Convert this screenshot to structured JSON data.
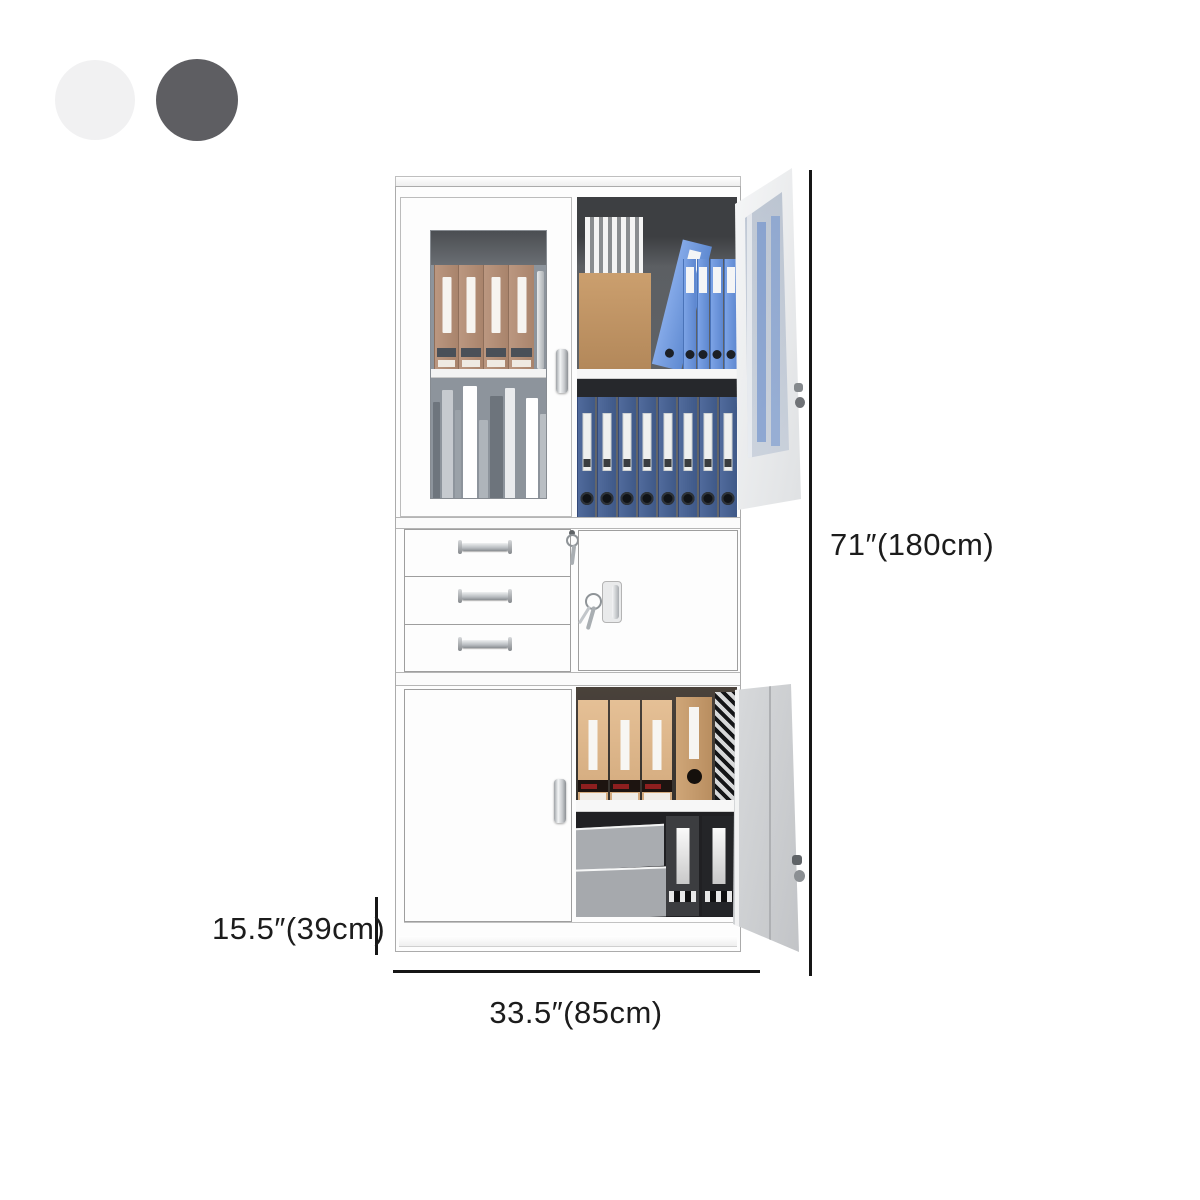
{
  "swatches": [
    {
      "name": "white",
      "color": "#F1F1F2"
    },
    {
      "name": "dark-gray",
      "color": "#5E5E62"
    }
  ],
  "dimensions": {
    "height_label": "71″(180cm)",
    "depth_label": "15.5″(39cm)",
    "width_label": "33.5″(85cm)"
  },
  "palette": {
    "dimension_line": "#161616",
    "cabinet_white": "#FCFCFC",
    "interior_dark": "#4E5053",
    "blue_binder": "#6D99E0",
    "navy_binder": "#46618F",
    "brown_binder": "#B28F77",
    "tan_folder": "#DDB78C",
    "open_door_gray": "#CDCFD2"
  }
}
